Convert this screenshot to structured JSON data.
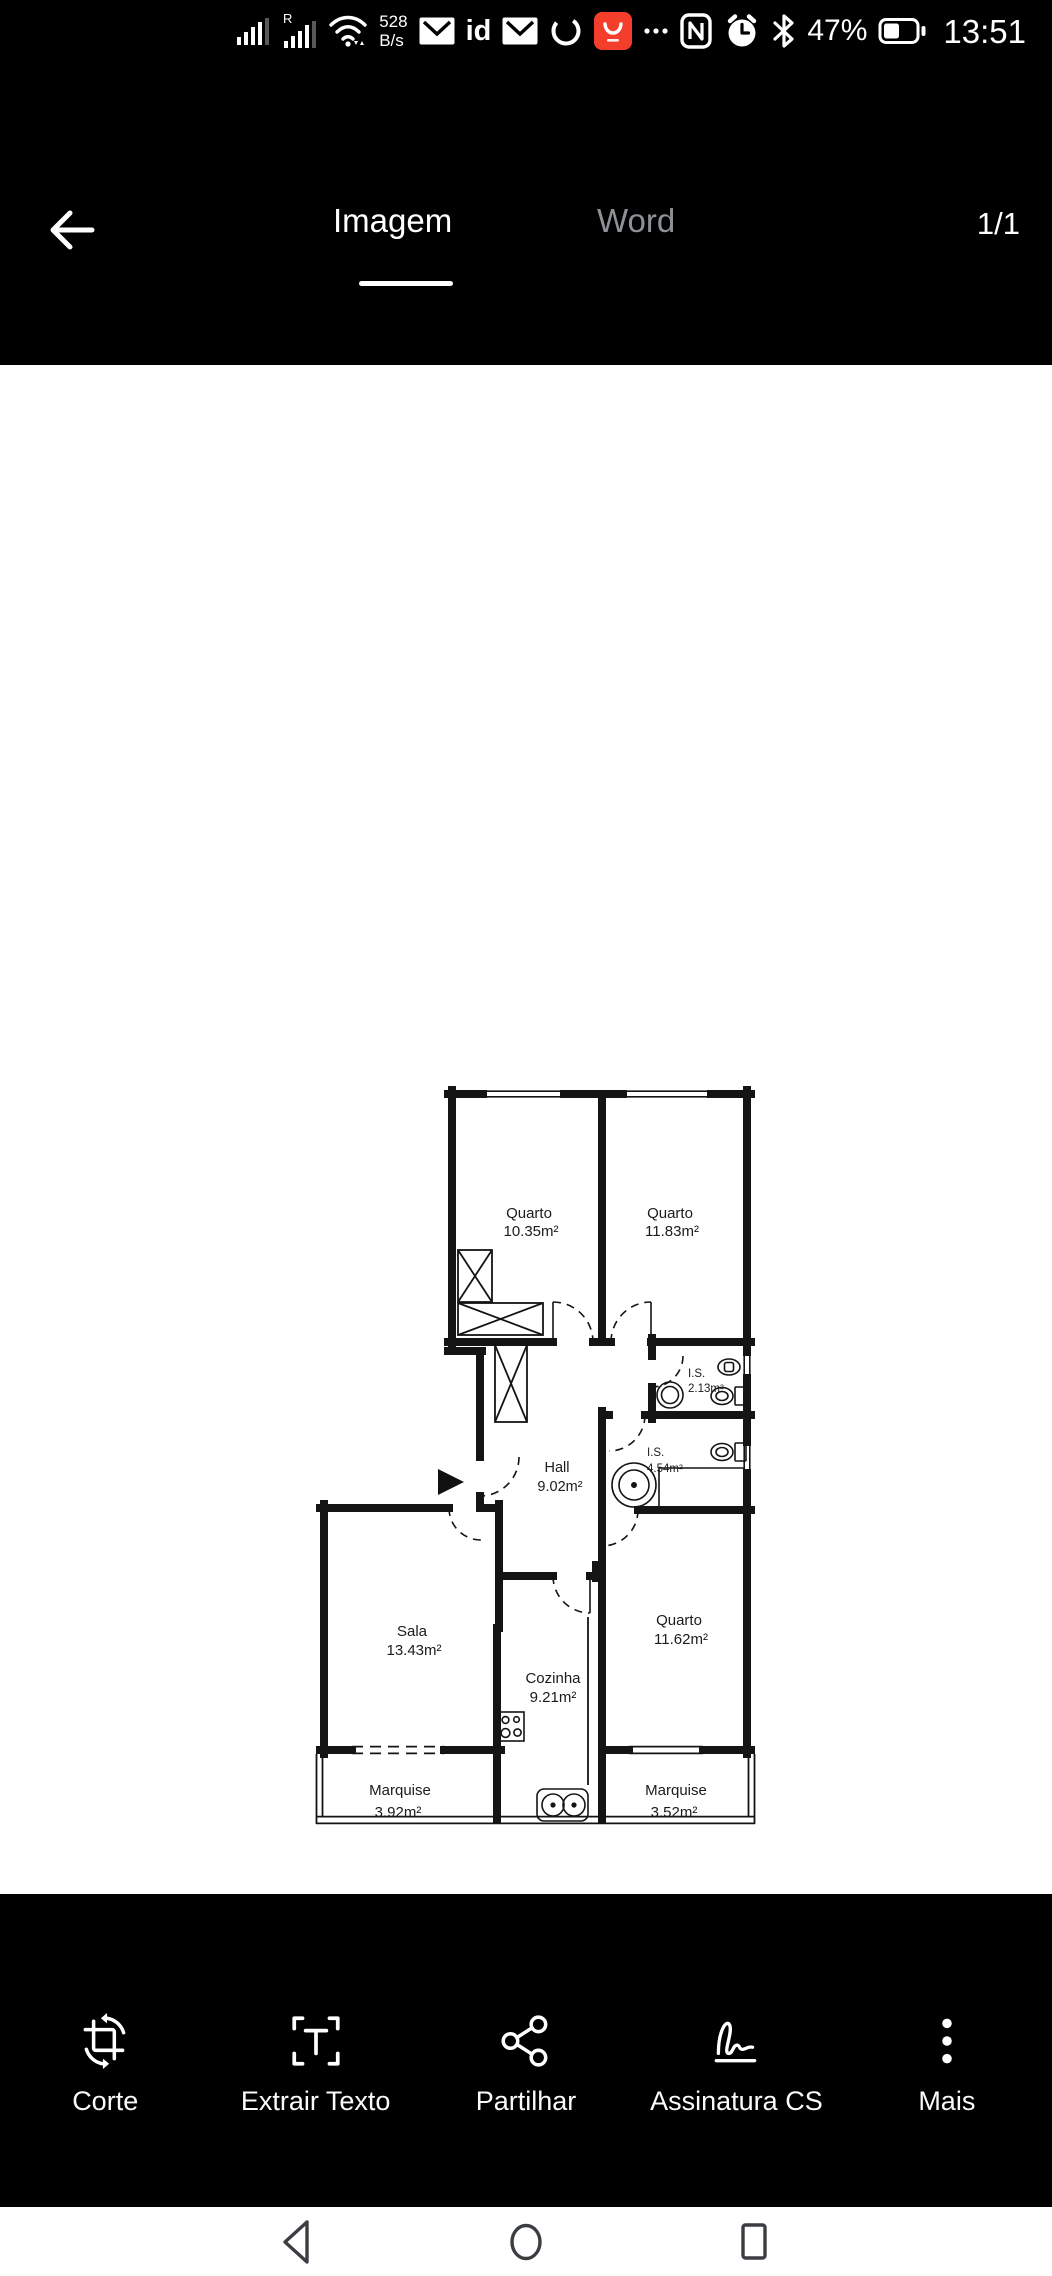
{
  "status_bar": {
    "time": "13:51",
    "battery": "47%",
    "net_speed_top": "528",
    "net_speed_bottom": "B/s",
    "roaming_badge": "R",
    "id_glyph": "id",
    "icons": [
      "signal-icon",
      "signal-roaming-icon",
      "wifi-icon",
      "network-speed",
      "mail-icon",
      "id-icon",
      "mail-icon",
      "sync-ring-icon",
      "shop-app-icon",
      "ellipsis-icon",
      "nfc-icon",
      "alarm-icon",
      "bluetooth-icon",
      "battery-icon"
    ],
    "app_icon_color": "#f43e2c"
  },
  "header": {
    "tabs": [
      {
        "label": "Imagem",
        "active": true
      },
      {
        "label": "Word",
        "active": false
      }
    ],
    "page_indicator": "1/1"
  },
  "plan": {
    "rooms": [
      {
        "name": "Quarto",
        "area": "10.35m²"
      },
      {
        "name": "Quarto",
        "area": "11.83m²"
      },
      {
        "name": "I.S.",
        "area": "2.13m²"
      },
      {
        "name": "I.S.",
        "area": "4.54m²"
      },
      {
        "name": "Hall",
        "area": "9.02m²"
      },
      {
        "name": "Sala",
        "area": "13.43m²"
      },
      {
        "name": "Cozinha",
        "area": "9.21m²"
      },
      {
        "name": "Quarto",
        "area": "11.62m²"
      },
      {
        "name": "Marquise",
        "area": "3.92m²"
      },
      {
        "name": "Marquise",
        "area": "3.52m²"
      }
    ],
    "legend": {
      "entrance": "Entrada da fração"
    },
    "fixtures": [
      "wardrobe",
      "closet",
      "wc-sink",
      "bidet",
      "toilet",
      "bathtub",
      "counter",
      "stove",
      "kitchen-sink"
    ]
  },
  "title_block": {
    "titulo_label": "Título:",
    "titulo": "Planta da situação existente - Apartamento T3",
    "tipo_imovel_label": "Tipo de imóvel",
    "tipo_imovel": "Habitação",
    "n_pisos_label": "N.º Pisos:",
    "n_pisos": "1",
    "morada_label": "Morada:",
    "morada_1": "Av. dos Missionários n.º 36, 1º Esq.",
    "morada_2": "2735-133 Agualva-Cacém, Sintra",
    "areas_label": "Áreas do Piso:",
    "area_bruta_1a": "Área Bruta",
    "area_bruta_1b": "Priv.: 88.00m²",
    "area_bruta_2a": "Área Bruta",
    "area_bruta_2b": "Depend.: 7.00m²",
    "area_util_a": "Área Útil:",
    "area_util_b": "72.13m²",
    "formato_label": "Formato:",
    "formato": "A4",
    "north": "N",
    "escala": "Escala 1/100",
    "scale_1": "1m",
    "scale_2": "2m",
    "levantamento_label": "Levantamento por:",
    "levantamento": "Horizon Conquest, Lda | NIPC: 517 176 297",
    "tecnico_label": "Técnico responsável:",
    "tecnico": "Arq. Urb. Rúben Baptista",
    "data_label": "Data:",
    "data": "15/03/2023",
    "desenho_label": "Desenho",
    "desenho": "01/01"
  },
  "toolbar": {
    "items": [
      {
        "label": "Corte",
        "icon": "crop-rotate-icon"
      },
      {
        "label": "Extrair Texto",
        "icon": "extract-text-icon"
      },
      {
        "label": "Partilhar",
        "icon": "share-icon"
      },
      {
        "label": "Assinatura CS",
        "icon": "signature-icon"
      },
      {
        "label": "Mais",
        "icon": "more-icon"
      }
    ]
  },
  "nav_bar": {
    "icons": [
      "back-icon",
      "home-icon",
      "recents-icon"
    ]
  },
  "colors": {
    "background": "#000000",
    "surface": "#ffffff",
    "inactive_tab": "#8e9296",
    "app_accent": "#f43e2c",
    "nav_icon": "#3a3d42",
    "line": "#111111"
  }
}
